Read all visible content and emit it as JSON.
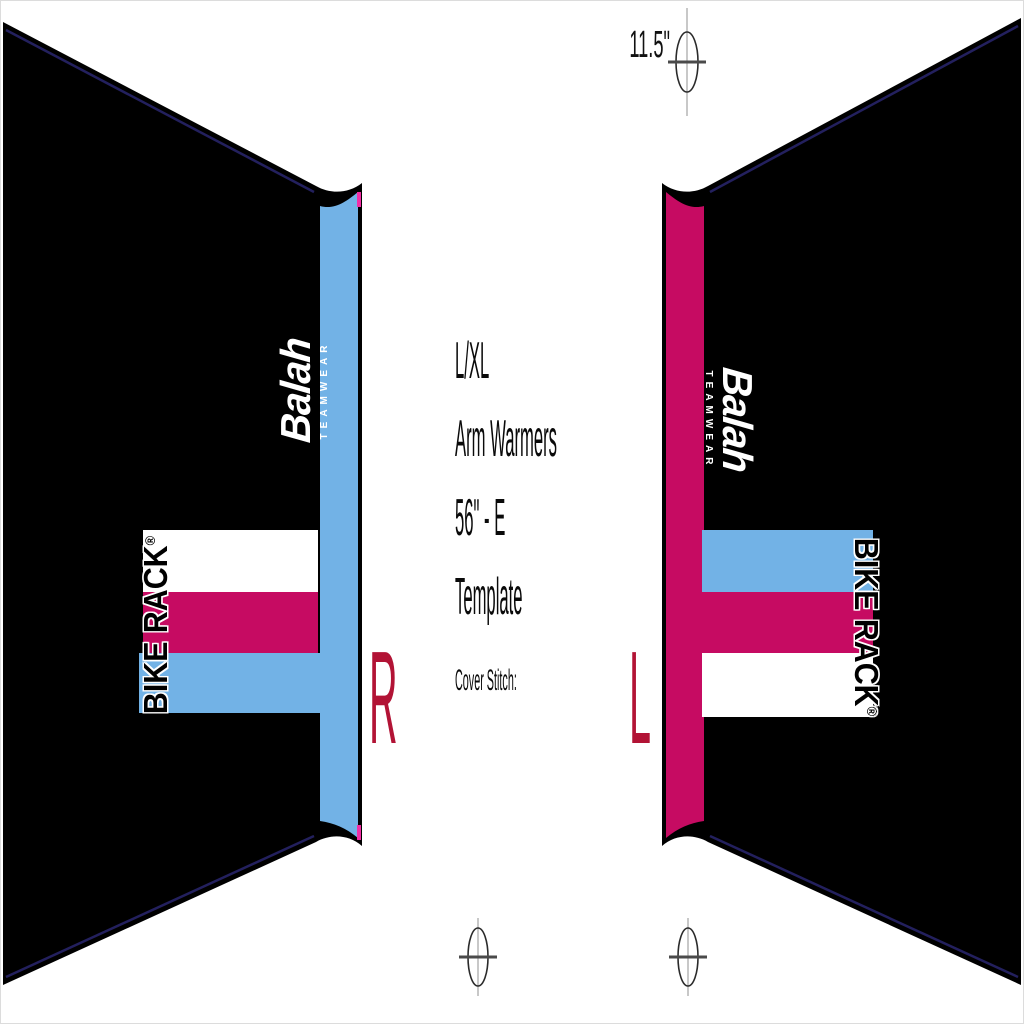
{
  "document": {
    "title_lines": [
      "L/XL",
      "Arm Warmers",
      "56\" - E",
      "Template"
    ],
    "cover_stitch_label": "Cover Stitch:",
    "top_measurement": "11.5\""
  },
  "branding": {
    "logo_text": "Balah",
    "logo_subtext": "TEAMWEAR",
    "sponsor_text": "BIKE RACK",
    "sponsor_reg": "®"
  },
  "panels": {
    "right_sleeve": {
      "label": "R"
    },
    "left_sleeve": {
      "label": "L"
    }
  },
  "icons": {
    "registration_mark": "crosshair-ellipse"
  },
  "colors": {
    "paper": "#ffffff",
    "ink": "#000000",
    "blue": "#72b2e6",
    "magenta": "#c60b62",
    "crimson": "#b21335",
    "navy": "#23205e",
    "notch_pink": "#f22ea6",
    "mark_gray": "#c8c8c8"
  }
}
